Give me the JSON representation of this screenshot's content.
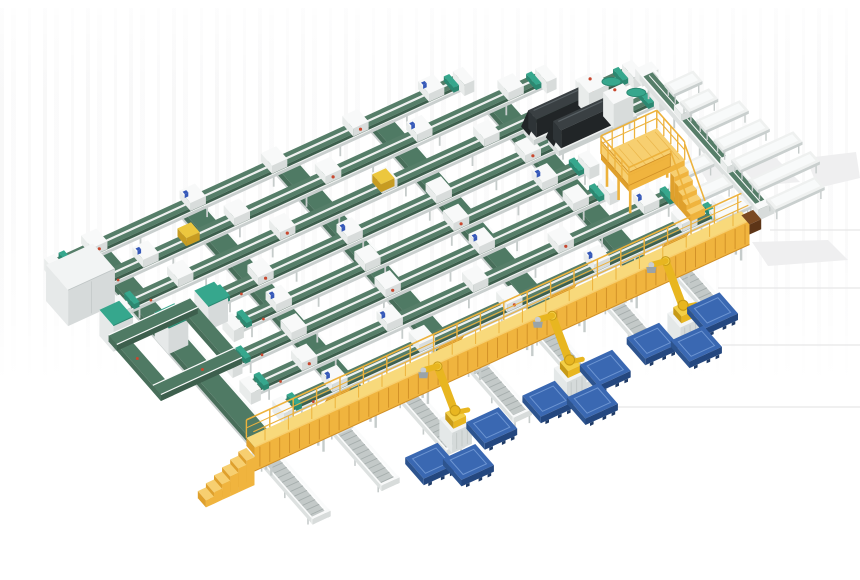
{
  "meta": {
    "title": "3D render of an automated conveyor sortation and robotic palletizing system",
    "canvas": {
      "width": 860,
      "height": 580
    }
  },
  "colors": {
    "belt_top": "#567e69",
    "belt_front": "#3d5f4d",
    "belt_side": "#486e5a",
    "belt2_top": "#4f7a64",
    "frame_top": "#eff1f0",
    "frame_front": "#c9cfce",
    "frame_side": "#dde1e0",
    "rail_white": "#fafbfb",
    "leg": "#c6cccb",
    "roller": "#a6aead",
    "spur_bed": "#c3c9c8",
    "teal": "#36a78d",
    "teal_dark": "#2b8871",
    "carrier_top": "#f8f9f9",
    "carrier_front": "#d8dcdb",
    "carrier_side": "#e9eceb",
    "yellow_deck": "#f8d97b",
    "yellow_face": "#f0b43e",
    "yellow_rib": "#d08f26",
    "yellow_rail": "#edb23c",
    "yellow_light": "#f7cf70",
    "yellow_side": "#dfa02c",
    "robot_y": "#e8b620",
    "robot_y2": "#f4cf45",
    "robot_dark": "#c79a17",
    "robot_gray": "#c8cdd2",
    "pedestal_top": "#f2f4f4",
    "pedestal_front": "#d5dada",
    "pedestal_side": "#e4e8e8",
    "pallet_top": "#3a68b2",
    "pallet_front": "#24477f",
    "pallet_side": "#2d548f",
    "pallet_line": "#6d95d2",
    "pallet_foot": "#1e3a66",
    "machine_top": "#3a4043",
    "machine_front": "#212527",
    "machine_side": "#2e3437",
    "machine_hi": "#596165",
    "box_top": "#f2f4f4",
    "box_front": "#d6dada",
    "box_side": "#e6e9e9",
    "red": "#c8472e",
    "blue": "#3558b8",
    "tote_yellow": "#ecc73e",
    "tote_yellow_dark": "#c79c22",
    "wedge_dark": "#7b4a22",
    "wedge_darker": "#5d3517",
    "shadow": "#ededee",
    "floor_line": "#e7e7e8",
    "white": "#ffffff"
  },
  "scene": {
    "iso": {
      "origin": [
        154,
        309
      ],
      "e": [
        0.9,
        -0.412
      ],
      "s": [
        0.58,
        0.66
      ]
    },
    "lanes": [
      {
        "v": -80,
        "u0": -60,
        "u1": 397
      },
      {
        "v": -42,
        "u0": -48,
        "u1": 464
      },
      {
        "v": -4,
        "u0": -36,
        "u1": 536
      },
      {
        "v": 34,
        "u0": 40,
        "u1": 540
      },
      {
        "v": 72,
        "u0": 40,
        "u1": 438
      },
      {
        "v": 110,
        "u0": 14,
        "u1": 436
      },
      {
        "v": 148,
        "u0": 10,
        "u1": 490
      },
      {
        "v": 186,
        "u0": 22,
        "u1": 513
      }
    ],
    "cross_belts": [
      {
        "u": -10,
        "v0": -88,
        "v1": 216
      },
      {
        "u": 95,
        "v0": -88,
        "v1": 216
      },
      {
        "u": 200,
        "v0": -88,
        "v1": 216
      },
      {
        "u": 305,
        "v0": -88,
        "v1": 216
      },
      {
        "u": 410,
        "v0": -48,
        "v1": 216
      }
    ],
    "gray_box": {
      "u0": -80,
      "v0": -62,
      "u1": -28,
      "v1": -24,
      "h": 36
    },
    "cabinets": [
      {
        "u0": -62,
        "v0": 2,
        "u1": -40,
        "v1": 26,
        "h": 26
      },
      {
        "u0": -20,
        "v0": 32,
        "u1": 2,
        "v1": 56,
        "h": 26
      },
      {
        "u0": 28,
        "v0": 26,
        "u1": 50,
        "v1": 50,
        "h": 24
      }
    ],
    "loop": {
      "u0": -60,
      "v0": 15,
      "u1": 30,
      "v1": 105,
      "w": 14
    },
    "machines": [
      {
        "u0": 408,
        "v0": 4,
        "u1": 495,
        "v1": 22
      },
      {
        "u0": 420,
        "v0": 28,
        "u1": 507,
        "v1": 46
      }
    ],
    "spine": {
      "u": 545,
      "v0": 4,
      "v1": 206
    },
    "benches_right": {
      "u0": 553,
      "u1": 585,
      "vs": [
        30,
        57
      ]
    },
    "chutes_right": {
      "u0": 553,
      "vs": [
        85,
        115,
        145,
        175,
        205
      ],
      "u1s": [
        601,
        605,
        622,
        622,
        608
      ]
    },
    "chutes_left": {
      "u0": 500,
      "u1": 537,
      "vs": [
        125,
        157,
        189
      ]
    },
    "mezzanine": {
      "u0": 440,
      "v0": 88,
      "u1": 502,
      "v1": 136,
      "deck": [
        26,
        32
      ],
      "stairs": {
        "u0": 486,
        "u1": 502,
        "v": 136,
        "steps": 5
      }
    },
    "bridge": {
      "u0": -43,
      "u1": 507,
      "v0": 226,
      "v1": 240,
      "deck": [
        30,
        38
      ],
      "face_bottom": 14,
      "ramps": [
        60,
        185,
        310,
        435
      ],
      "leg_every": 58,
      "post_every": 26,
      "stairs": {
        "steps": 6,
        "du": 9
      }
    },
    "spurs": [
      {
        "u": -20,
        "v0": 215,
        "v1": 320
      },
      {
        "u": 58,
        "v0": 215,
        "v1": 318
      },
      {
        "u": 134,
        "v0": 215,
        "v1": 312
      },
      {
        "u": 210,
        "v0": 215,
        "v1": 310
      },
      {
        "u": 286,
        "v0": 215,
        "v1": 308
      },
      {
        "u": 362,
        "v0": 215,
        "v1": 304
      },
      {
        "u": 438,
        "v0": 215,
        "v1": 300
      }
    ],
    "robots": [
      {
        "u": 147,
        "v": 291
      },
      {
        "u": 273,
        "v": 293
      },
      {
        "u": 401,
        "v": 290
      }
    ],
    "pallets": [
      {
        "u": 180,
        "v": 303
      },
      {
        "u": 107,
        "v": 311
      },
      {
        "u": 136,
        "v": 331
      },
      {
        "u": 310,
        "v": 297
      },
      {
        "u": 243,
        "v": 302
      },
      {
        "u": 277,
        "v": 326
      },
      {
        "u": 435,
        "v": 288
      },
      {
        "u": 366,
        "v": 291
      },
      {
        "u": 399,
        "v": 316
      }
    ],
    "totes": [
      {
        "u": 58,
        "lane_v": -42
      },
      {
        "u": 250,
        "lane_v": -4
      }
    ],
    "floor_lines": [
      [
        770,
        230,
        860,
        230
      ],
      [
        718,
        288,
        860,
        288
      ],
      [
        722,
        345,
        860,
        345
      ],
      [
        617,
        407,
        860,
        407
      ]
    ],
    "shadows": [
      [
        [
          696,
          162
        ],
        [
          776,
          158
        ],
        [
          800,
          182
        ],
        [
          712,
          190
        ]
      ],
      [
        [
          752,
          242
        ],
        [
          828,
          240
        ],
        [
          848,
          260
        ],
        [
          768,
          266
        ]
      ],
      [
        [
          806,
          158
        ],
        [
          856,
          152
        ],
        [
          860,
          178
        ],
        [
          818,
          188
        ]
      ]
    ]
  }
}
